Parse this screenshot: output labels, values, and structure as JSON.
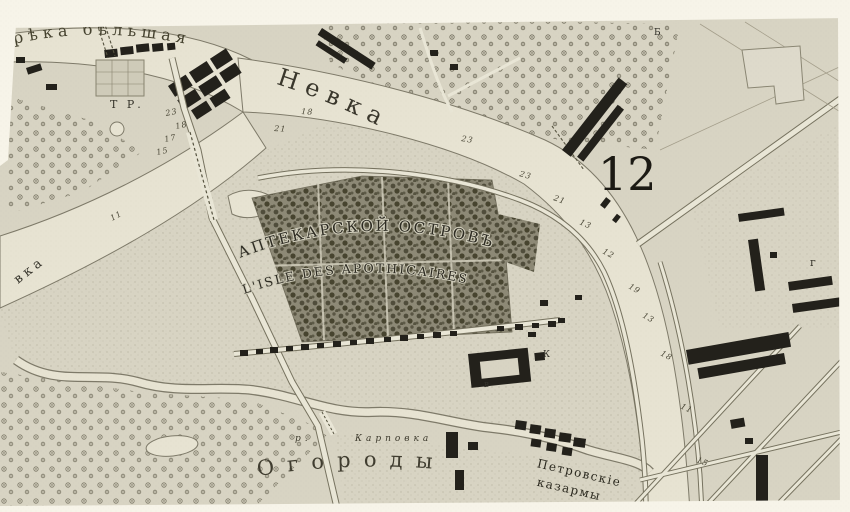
{
  "map": {
    "kind": "historical-engraved-city-map",
    "colors": {
      "paper_margin": "#f7f4e9",
      "land": "#d8d4c3",
      "water": "#e7e3d2",
      "road": "#e9e6d6",
      "shore": "#7e7a69",
      "buildings": "#23211b",
      "woods_dark": "#504d3b",
      "ink_text": "#33312a"
    },
    "labels": {
      "river_top": "рѣка бѣльшая",
      "nevka": "Невка",
      "nevka_left_fragment": "вка",
      "karpovka_abbrev": "р.",
      "karpovka": "Карповка",
      "island_ru": "АПТЕКАРСКОЙ ОСТРОВЪ",
      "island_fr": "L'ISLE DES APOTHICAIRES",
      "ogorody": "Огороды",
      "barracks1": "Петровскіе",
      "barracks2": "казармы",
      "plate": "12",
      "tr": "Т Р.",
      "letter_ve": "вѣ",
      "letter_b": "Б",
      "letter_g": "г",
      "letter_k": "К",
      "letter_v": "в"
    },
    "soundings": [
      "23",
      "18",
      "17",
      "15",
      "11",
      "21",
      "18",
      "23",
      "23",
      "21",
      "13",
      "12",
      "19",
      "13",
      "18",
      "11",
      "15"
    ]
  }
}
